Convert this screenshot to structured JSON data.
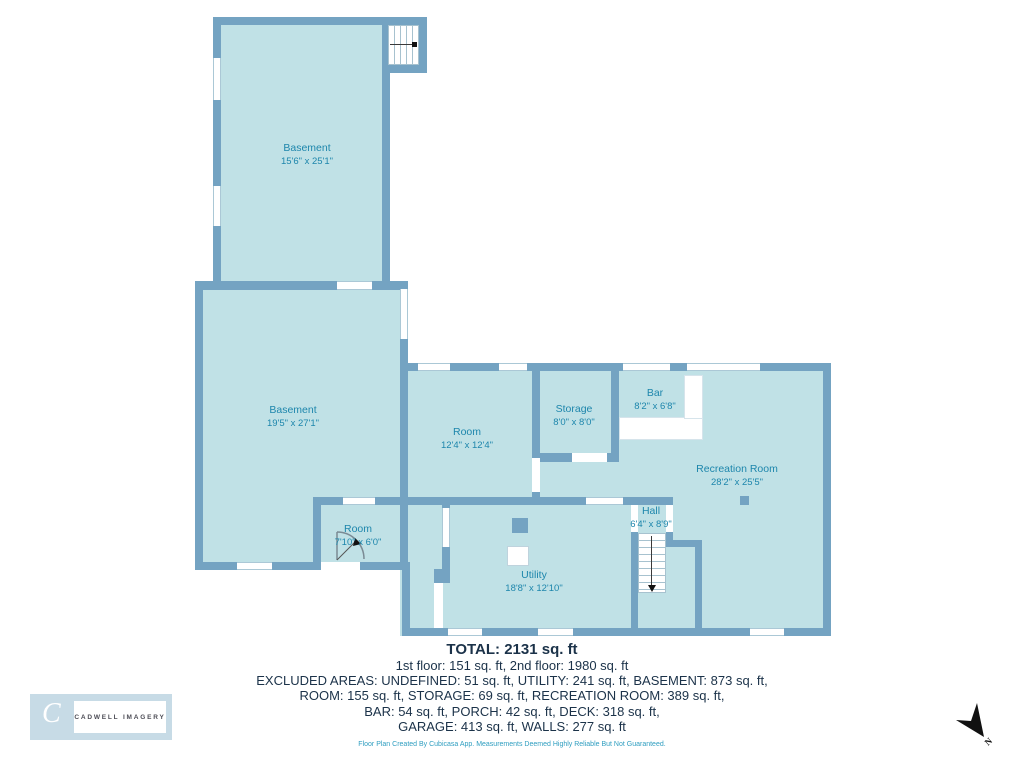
{
  "plan": {
    "rooms": [
      {
        "name": "Basement",
        "dims": "15'6\" x 25'1\""
      },
      {
        "name": "Basement",
        "dims": "19'5\" x 27'1\""
      },
      {
        "name": "Room",
        "dims": "12'4\" x 12'4\""
      },
      {
        "name": "Storage",
        "dims": "8'0\" x 8'0\""
      },
      {
        "name": "Bar",
        "dims": "8'2\" x 6'8\""
      },
      {
        "name": "Recreation Room",
        "dims": "28'2\" x 25'5\""
      },
      {
        "name": "Hall",
        "dims": "6'4\" x 8'9\""
      },
      {
        "name": "Room",
        "dims": "7'10\" x 6'0\""
      },
      {
        "name": "Utility",
        "dims": "18'8\" x 12'10\""
      }
    ],
    "colors": {
      "wall": "#74A3C2",
      "floor": "#C0E1E6",
      "room_label": "#1D86AC",
      "summary_text": "#1B3249",
      "disclaimer_text": "#2F9EC0"
    }
  },
  "summary": {
    "total": "TOTAL: 2131 sq. ft",
    "lines": [
      "1st floor: 151 sq. ft, 2nd floor: 1980 sq. ft",
      "EXCLUDED AREAS: UNDEFINED: 51 sq. ft, UTILITY: 241 sq. ft, BASEMENT: 873 sq. ft,",
      "ROOM: 155 sq. ft, STORAGE: 69 sq. ft, RECREATION ROOM: 389 sq. ft,",
      "BAR: 54 sq. ft, PORCH: 42 sq. ft, DECK: 318 sq. ft,",
      "GARAGE: 413 sq. ft, WALLS: 277 sq. ft"
    ],
    "disclaimer": "Floor Plan Created By Cubicasa App. Measurements Deemed Highly Reliable But Not Guaranteed."
  },
  "logo": {
    "initial": "C",
    "name": "CADWELL IMAGERY"
  },
  "compass": {
    "label": "N"
  }
}
